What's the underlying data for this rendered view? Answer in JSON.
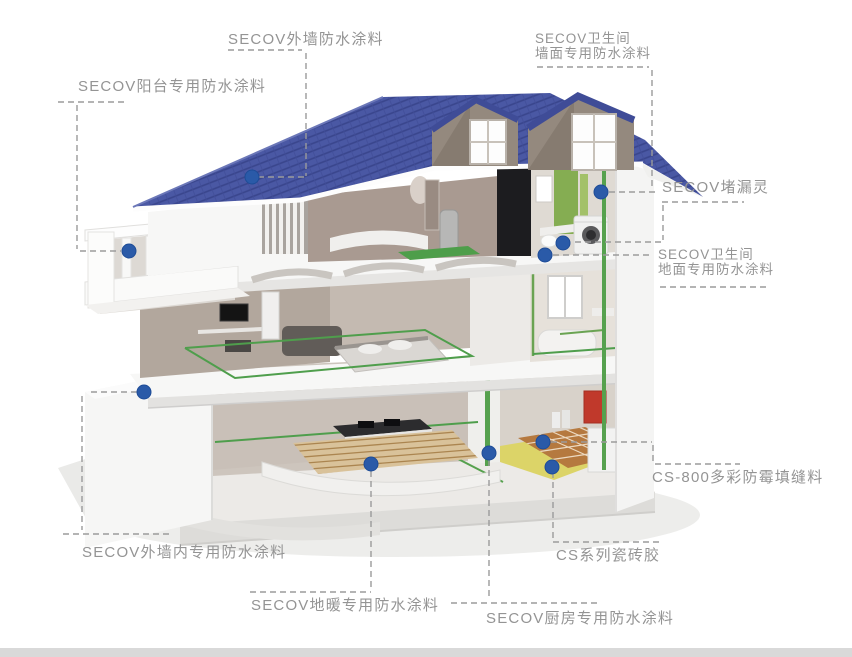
{
  "diagram": {
    "brand": "SECOV",
    "labels": [
      {
        "id": "exterior-wall-coating",
        "lines": [
          "SECOV外墙防水涂料"
        ]
      },
      {
        "id": "balcony-coating",
        "lines": [
          "SECOV阳台专用防水涂料"
        ]
      },
      {
        "id": "bathroom-wall-coating",
        "lines": [
          "SECOV卫生间",
          "墙面专用防水涂料"
        ]
      },
      {
        "id": "leak-stopper",
        "lines": [
          "SECOV堵漏灵"
        ]
      },
      {
        "id": "bathroom-floor-coating",
        "lines": [
          "SECOV卫生间",
          "地面专用防水涂料"
        ]
      },
      {
        "id": "cs800-antimold-grout",
        "lines": [
          "CS-800多彩防霉填缝料"
        ]
      },
      {
        "id": "cs-series-tile-adhesive",
        "lines": [
          "CS系列瓷砖胶"
        ]
      },
      {
        "id": "interior-exterior-wall-coating",
        "lines": [
          "SECOV外墙内专用防水涂料"
        ]
      },
      {
        "id": "floor-heating-coating",
        "lines": [
          "SECOV地暖专用防水涂料"
        ]
      },
      {
        "id": "kitchen-coating",
        "lines": [
          "SECOV厨房专用防水涂料"
        ]
      }
    ],
    "colors": {
      "marker_blue": "#2a5aa8",
      "roof_blue": "#4a58a4",
      "waterproof_green": "#4f9e4c",
      "membrane_yellow": "#dcd468",
      "tile_brown": "#b5793f",
      "label_text": "#949494",
      "footer_bar": "#d9d9d9"
    }
  }
}
